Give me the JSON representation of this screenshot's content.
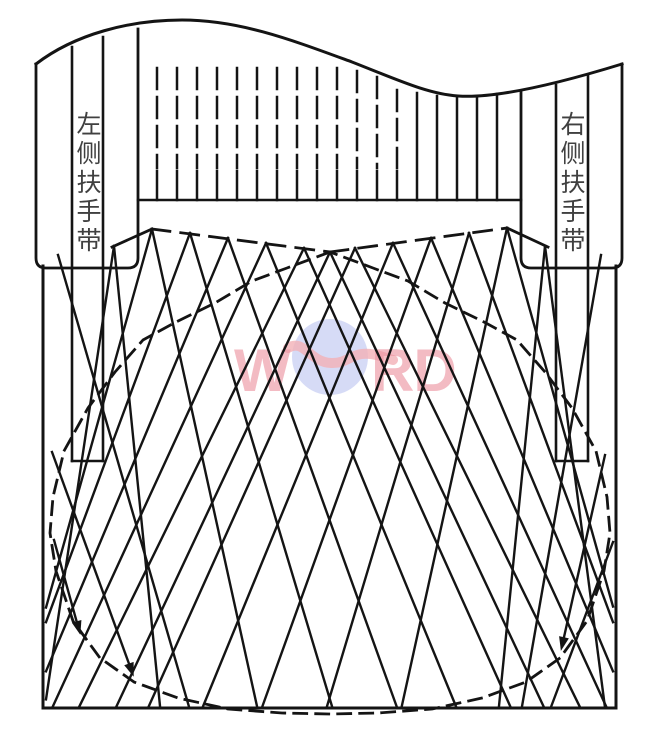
{
  "diagram": {
    "labels": {
      "left_handrail": "左侧扶手带",
      "right_handrail": "右侧扶手带"
    },
    "watermark": {
      "left": "W",
      "right": "RD"
    },
    "colors": {
      "ink": "#141414",
      "label": "#404040",
      "background": "#ffffff",
      "watermark_text": "#ec93a0",
      "watermark_globe": "#b5bdee",
      "watermark_swoosh": "#f3b0b6"
    }
  }
}
